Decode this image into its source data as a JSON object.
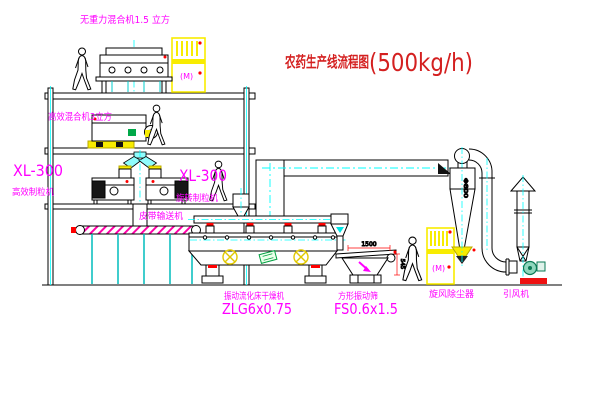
{
  "title": {
    "text": "农药生产线流程图",
    "capacity": "(500kg/h)"
  },
  "equipment": {
    "mixer_top": {
      "label": "无重力混合机1.5 立方"
    },
    "mixer_mid": {
      "label": "高效混合机3立方"
    },
    "granulator_left": {
      "model": "XL-300",
      "name": "高效制粒机"
    },
    "granulator_right": {
      "model": "XL-300",
      "name": "旋转制粒机"
    },
    "belt_conveyor": {
      "name": "皮带输送机"
    },
    "dryer": {
      "name": "振动流化床干燥机",
      "model": "ZLG6x0.75"
    },
    "screen": {
      "name": "方形振动筛",
      "model": "FS0.6x1.5"
    },
    "cyclone": {
      "name": "旋风除尘器",
      "diameter": "Φ800"
    },
    "fan": {
      "name": "引风机"
    }
  },
  "dimensions": {
    "screen_length": "1500",
    "screen_height": "545"
  },
  "cabinets": {
    "mark": "(M)"
  },
  "colors": {
    "label_magenta": "#ff00ff",
    "title_red": "#d42020",
    "line_black": "#000000",
    "centerline_cyan": "#00ffff",
    "cabinet_yellow": "#f8ec00",
    "accent_red": "#ff0000",
    "fan_green": "#0b7a55",
    "background": "#ffffff"
  }
}
